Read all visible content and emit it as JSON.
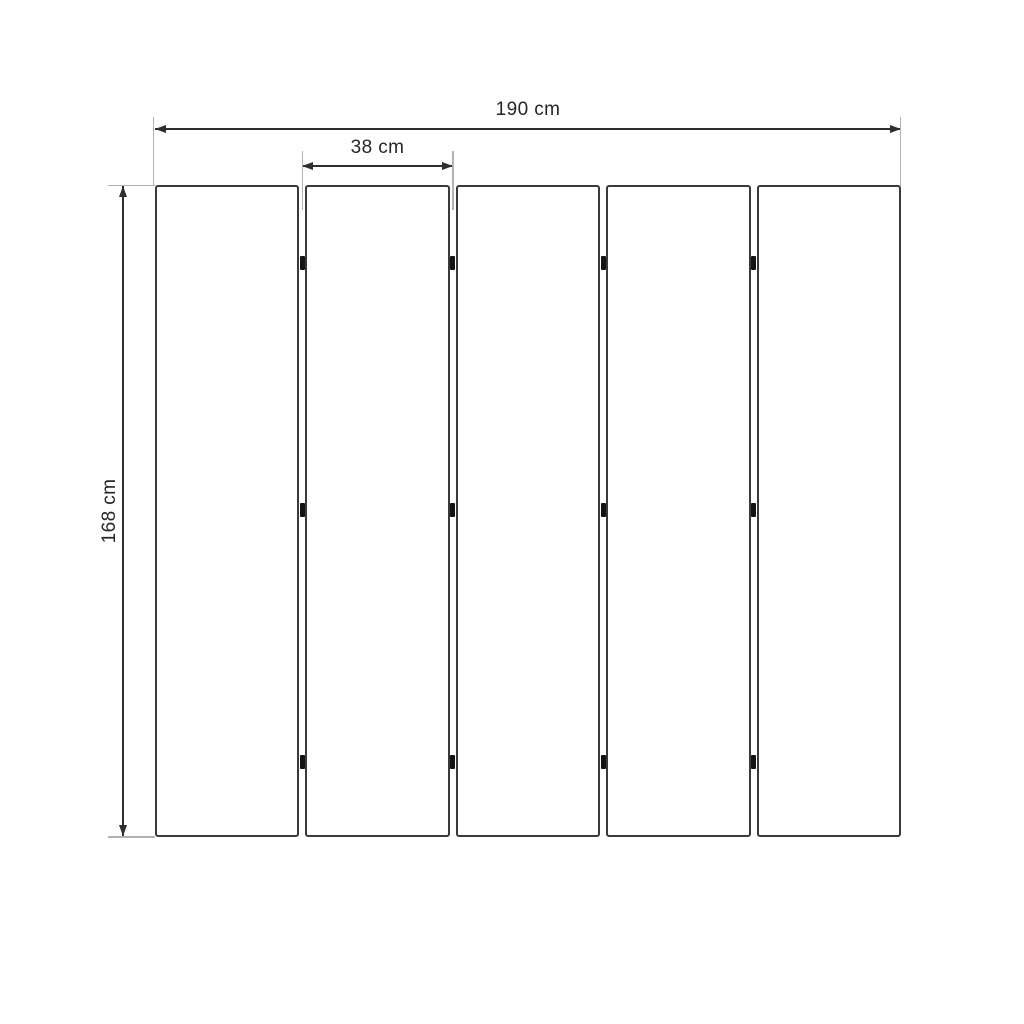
{
  "diagram": {
    "dimensions": {
      "total_width": "190 cm",
      "single_panel_width": "38 cm",
      "height": "168 cm"
    },
    "panels": {
      "count": 5,
      "joints": 4,
      "hinges_per_joint": 3
    },
    "colors": {
      "background": "#ffffff",
      "panel_border": "#3a3a3a",
      "dimension_line": "#2e2e2e",
      "extension_line": "#b3b3b3",
      "hinge": "#141414",
      "label_text": "#262626"
    }
  }
}
